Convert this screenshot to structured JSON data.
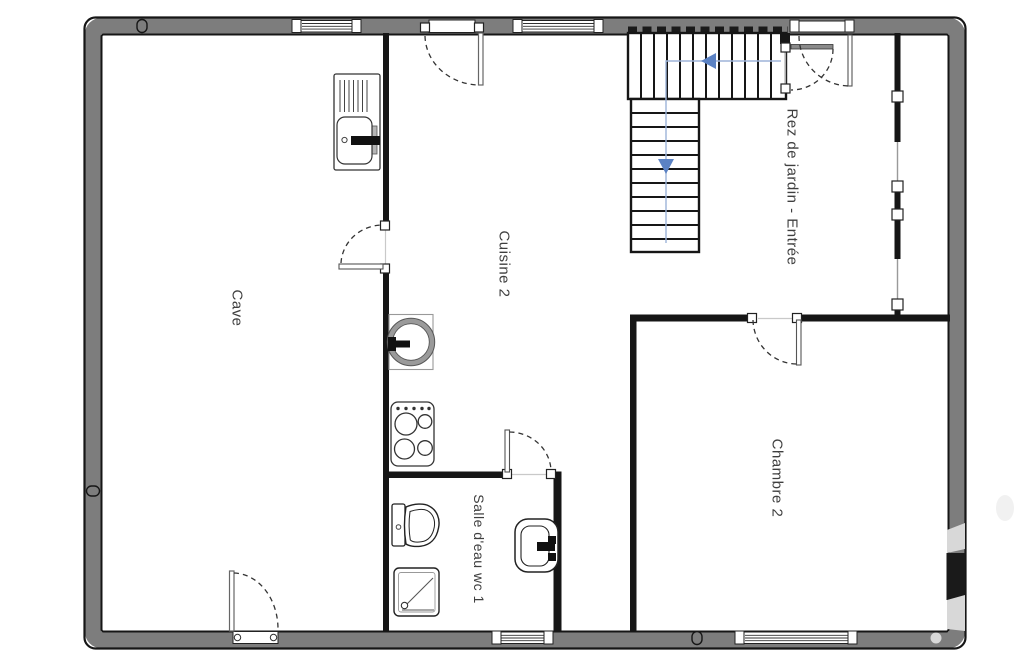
{
  "rooms": [
    {
      "name": "cave",
      "label": "Cave"
    },
    {
      "name": "cuisine",
      "label": "Cuisine 2"
    },
    {
      "name": "entree",
      "label": "Rez de jardin - Entrée"
    },
    {
      "name": "chambre",
      "label": "Chambre 2"
    },
    {
      "name": "salle-eau",
      "label": "Salle d'eau wc 1"
    }
  ],
  "stairs": {
    "upper_run_treads": 12,
    "lower_run_treads": 11,
    "walk_arrows": [
      "left",
      "down"
    ]
  },
  "fixtures": [
    "kitchen-sink-with-drainer",
    "round-sink",
    "stove-four-burners",
    "toilet",
    "shower-tray",
    "washbasin"
  ],
  "doors": [
    "exterior-door-top",
    "cave-cuisine-door",
    "salle-eau-door",
    "chambre-door",
    "entrance-double-door",
    "exterior-door-bottom-left"
  ],
  "window_count": 5,
  "colors": {
    "wall_gray": "#7d7d7d",
    "wall_black": "#161616",
    "arrow_blue": "#5b82c4",
    "walk_line_blue": "#9db4d8",
    "label_text": "#3f3f3f",
    "watermark_gray": "#d8d8d8"
  }
}
